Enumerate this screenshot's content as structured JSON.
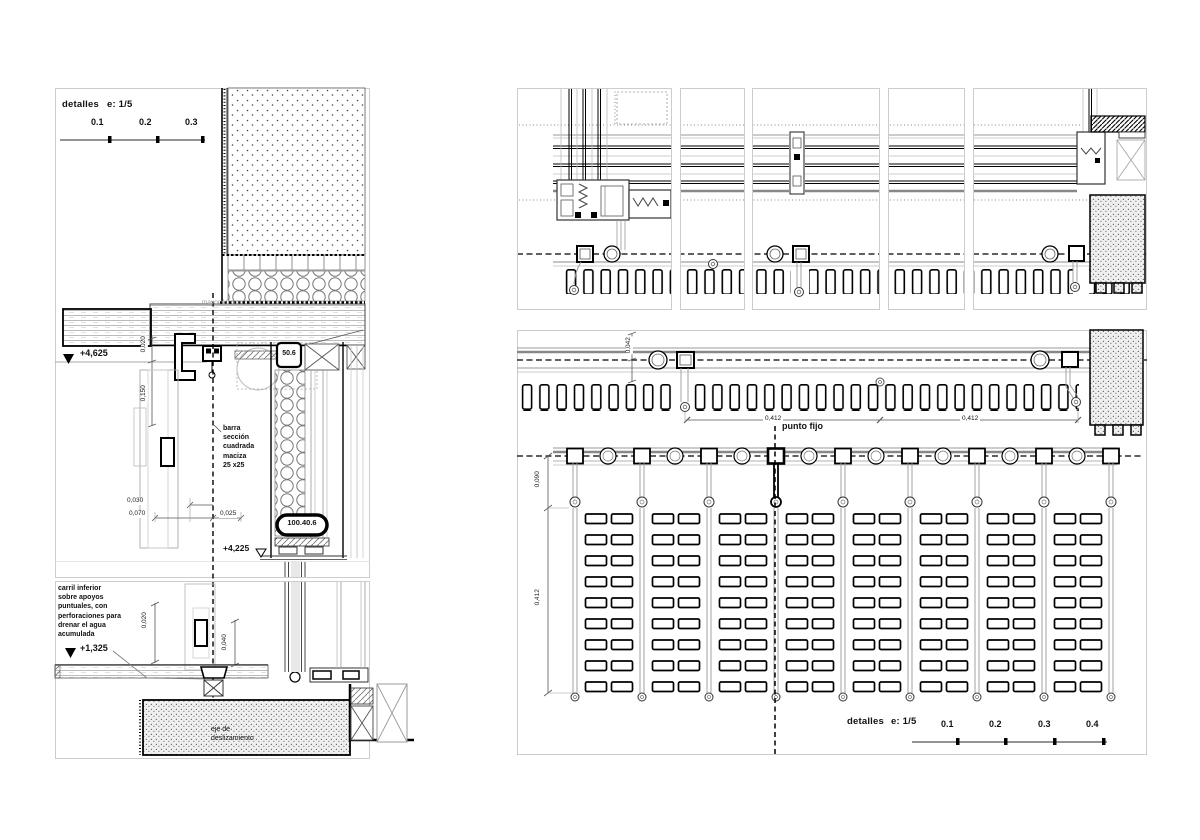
{
  "palette": {
    "paper": "#ffffff",
    "ink": "#000000",
    "mid_gray": "#888888",
    "light_gray": "#bbbbbb",
    "panel_border": "#cccccc"
  },
  "left_section": {
    "scale": {
      "title": "detalles",
      "ratio": "e: 1/5",
      "tick1": "0.1",
      "tick2": "0.2",
      "tick3": "0.3"
    },
    "level_top": "+4,625",
    "level_mid": "+4,225",
    "level_bottom": "+1,325",
    "dim_020_head": "0,020",
    "dim_150": "0,150",
    "dim_030": "0,030",
    "dim_070": "0,070",
    "dim_025": "0,025",
    "dim_020_sill": "0,020",
    "dim_040": "0,040",
    "tag_506": "50.6",
    "tag_100406": "100.40.6",
    "note_bar": "barra\nsección\ncuadrada\nmaciza\n25 x25",
    "note_slab": "mayor 10 cm",
    "note_rail": "carril inferior\nsobre apoyos\npuntuales, con\nperforaciones para\ndrenar el agua\nacumulada",
    "note_axis": "eje de\ndeslizamiento"
  },
  "plan_bottom": {
    "dim_042": "0,042",
    "dim_412_left": "0,412",
    "dim_412_right": "0,412",
    "dim_090": "0,090",
    "dim_412_vert": "0,412",
    "label_fixed_point": "punto fijo",
    "scale": {
      "title": "detalles",
      "ratio": "e: 1/5",
      "tick1": "0.1",
      "tick2": "0.2",
      "tick3": "0.3",
      "tick4": "0.4"
    }
  }
}
